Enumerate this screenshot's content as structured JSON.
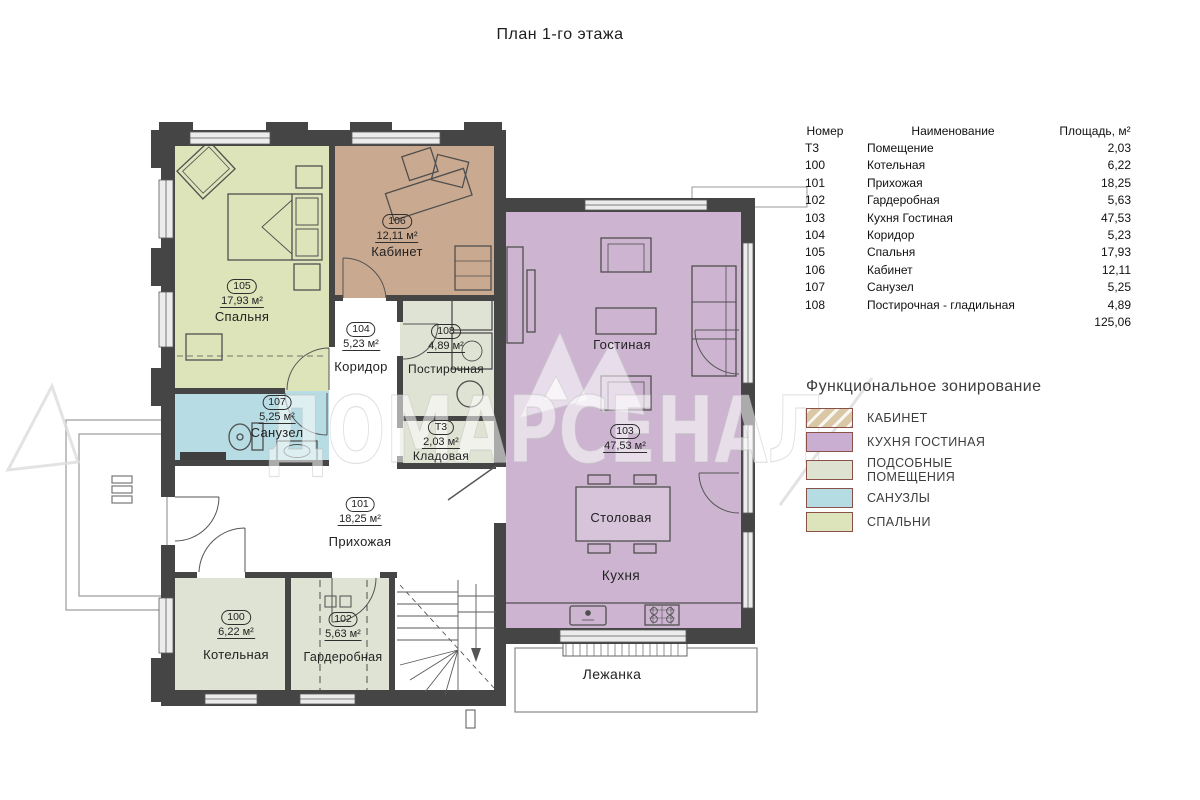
{
  "title": "План 1-го этажа",
  "watermark": {
    "text": "ДОМАРСЕНАЛ"
  },
  "colors": {
    "wall": "#454545",
    "office": "#c9a98f",
    "kitchen_living": "#cdb5d1",
    "utility": "#dfe3d3",
    "bathroom": "#b7dce3",
    "bedroom": "#dee4ba",
    "white": "#ffffff",
    "dining_table": "#d7c3da"
  },
  "rooms": {
    "spalnya": {
      "num": "105",
      "area": "17,93 м²",
      "name": "Спальня"
    },
    "kabinet": {
      "num": "106",
      "area": "12,11 м²",
      "name": "Кабинет"
    },
    "koridor": {
      "num": "104",
      "area": "5,23 м²",
      "name": "Коридор"
    },
    "postirochnaya": {
      "num": "108",
      "area": "4,89 м²",
      "name": "Постирочная"
    },
    "sanuzel": {
      "num": "107",
      "area": "5,25 м²",
      "name": "Санузел"
    },
    "kladovaya": {
      "num": "Т3",
      "area": "2,03 м²",
      "name": "Кладовая"
    },
    "prihozhaya": {
      "num": "101",
      "area": "18,25 м²",
      "name": "Прихожая"
    },
    "kotelnaya": {
      "num": "100",
      "area": "6,22 м²",
      "name": "Котельная"
    },
    "garderobnaya": {
      "num": "102",
      "area": "5,63 м²",
      "name": "Гардеробная"
    },
    "kuhnya_gostinaya": {
      "num": "103",
      "area": "47,53 м²"
    }
  },
  "labels": {
    "gostinaya": "Гостиная",
    "stolovaya": "Столовая",
    "kuhnya": "Кухня",
    "lezhanka": "Лежанка"
  },
  "table": {
    "headers": [
      "Номер",
      "Наименование",
      "Площадь, м²"
    ],
    "rows": [
      {
        "num": "Т3",
        "name": "Помещение",
        "area": "2,03"
      },
      {
        "num": "100",
        "name": "Котельная",
        "area": "6,22"
      },
      {
        "num": "101",
        "name": "Прихожая",
        "area": "18,25"
      },
      {
        "num": "102",
        "name": "Гардеробная",
        "area": "5,63"
      },
      {
        "num": "103",
        "name": "Кухня Гостиная",
        "area": "47,53"
      },
      {
        "num": "104",
        "name": "Коридор",
        "area": "5,23"
      },
      {
        "num": "105",
        "name": "Спальня",
        "area": "17,93"
      },
      {
        "num": "106",
        "name": "Кабинет",
        "area": "12,11"
      },
      {
        "num": "107",
        "name": "Санузел",
        "area": "5,25"
      },
      {
        "num": "108",
        "name": "Постирочная - гладильная",
        "area": "4,89"
      }
    ],
    "total": "125,06"
  },
  "legend": {
    "title": "Функциональное зонирование",
    "items": [
      {
        "label": "КАБИНЕТ",
        "color": "#d9c7a6"
      },
      {
        "label": "КУХНЯ ГОСТИНАЯ",
        "color": "#c9aed2"
      },
      {
        "label": "ПОДСОБНЫЕ ПОМЕЩЕНИЯ",
        "color": "#dee2d0"
      },
      {
        "label": "САНУЗЛЫ",
        "color": "#b5dbe3"
      },
      {
        "label": "СПАЛЬНИ",
        "color": "#dde4bb"
      }
    ]
  }
}
